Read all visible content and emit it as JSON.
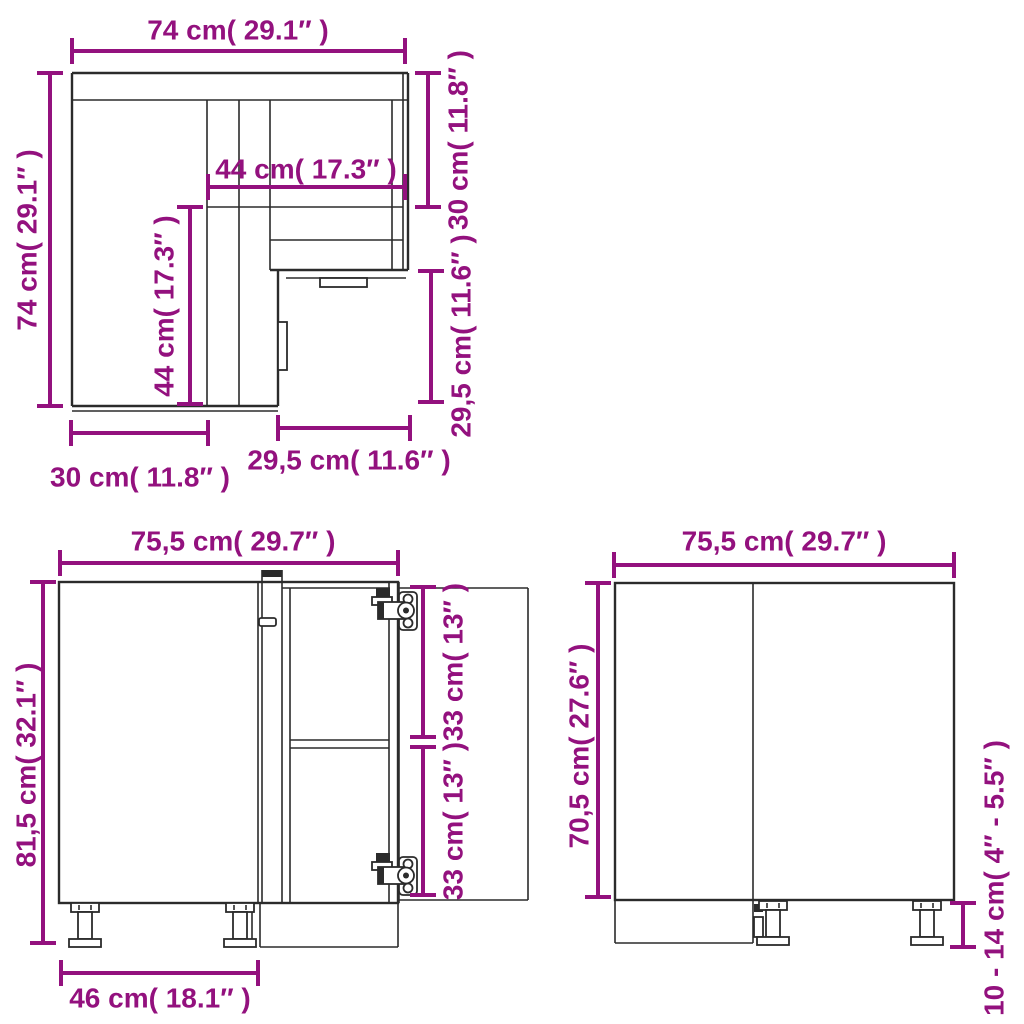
{
  "colors": {
    "accent": "#93117E",
    "line": "#2b2b2b"
  },
  "views": {
    "top": {
      "width": "74 cm( 29.1″ )",
      "depth": "74 cm( 29.1″ )",
      "inner_width": "44 cm( 17.3″ )",
      "inner_depth": "44 cm( 17.3″ )",
      "right_upper": "30 cm( 11.8″ )",
      "right_lower": "29,5 cm( 11.6″ )",
      "bottom_left": "30 cm( 11.8″ )",
      "bottom_right": "29,5 cm( 11.6″ )"
    },
    "front": {
      "width": "75,5 cm( 29.7″ )",
      "height": "81,5 cm( 32.1″ )",
      "upper_compartment": "33 cm( 13″ )",
      "lower_compartment": "33 cm( 13″ )",
      "door_width": "46 cm( 18.1″ )"
    },
    "side": {
      "width": "75,5 cm( 29.7″ )",
      "height": "70,5 cm( 27.6″ )",
      "leg_height": "10 - 14 cm( 4″ - 5.5″ )"
    }
  }
}
